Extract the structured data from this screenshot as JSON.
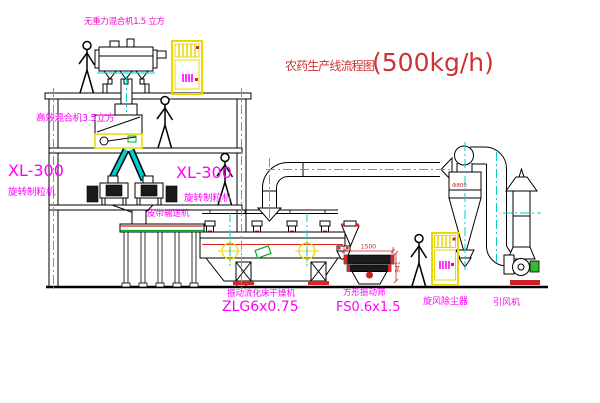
{
  "title": {
    "name_cn": "农药生产线流程图",
    "capacity": "(500kg/h)"
  },
  "equipment_labels": {
    "top_mixer": "无重力混合机1.5 立方",
    "mid_mixer": "高效混合机3.5立方",
    "granulator_left_model": "XL-300",
    "granulator_left_name": "旋转制粒机",
    "granulator_right_model": "XL-300",
    "granulator_right_name": "旋转制粒机",
    "belt_conveyor": "皮带输送机",
    "dryer_name": "振动流化床干燥机",
    "dryer_model": "ZLG6x0.75",
    "screen_name": "方形振动筛",
    "screen_model": "FS0.6x1.5",
    "cyclone_name": "旋风除尘器",
    "fan_name": "引风机"
  },
  "dimensions": {
    "screen_length": "1500",
    "screen_height": "941",
    "cyclone_diameter": "Φ800"
  },
  "colors": {
    "line": "#000000",
    "centerline_cyan": "#00cccc",
    "label_magenta": "#ff00ff",
    "annotation_red": "#cc2222",
    "cabinet_yellow": "#e8d800",
    "green": "#00aa22",
    "background": "#ffffff"
  }
}
